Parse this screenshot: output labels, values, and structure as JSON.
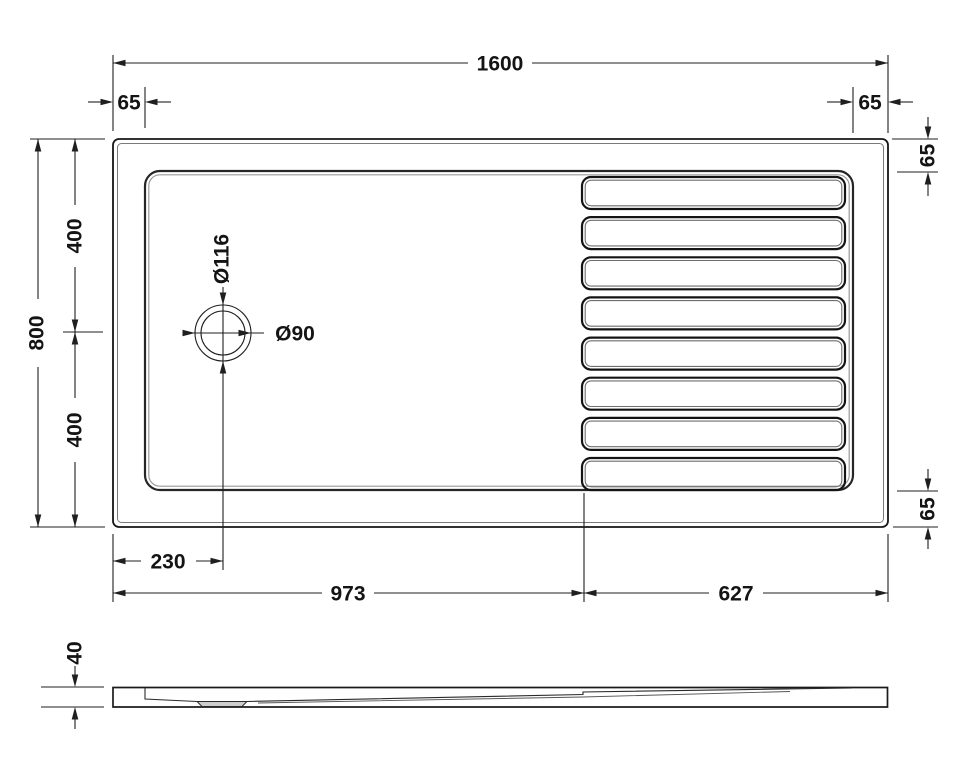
{
  "drawing": {
    "subject": "Rectangular walk-in shower tray technical drawing, plan view and side elevation",
    "background": "#ffffff",
    "line_color": "#1f1f1f",
    "text_color": "#141414",
    "drain_plate_fill": "#cdcdcd"
  },
  "plan_view": {
    "dims": {
      "overall_width": "1600",
      "overall_depth": "800",
      "rim_left": "65",
      "rim_right": "65",
      "rim_top_right": "65",
      "rim_bottom_right": "65",
      "depth_upper": "400",
      "depth_lower": "400",
      "drain_offset_x": "230",
      "smooth_zone_width": "973",
      "ribbed_zone_width": "627",
      "drain_outer_dia": "Ø116",
      "drain_inner_dia": "Ø90"
    },
    "rib_count": 8
  },
  "side_view": {
    "dims": {
      "tray_height": "40"
    }
  }
}
